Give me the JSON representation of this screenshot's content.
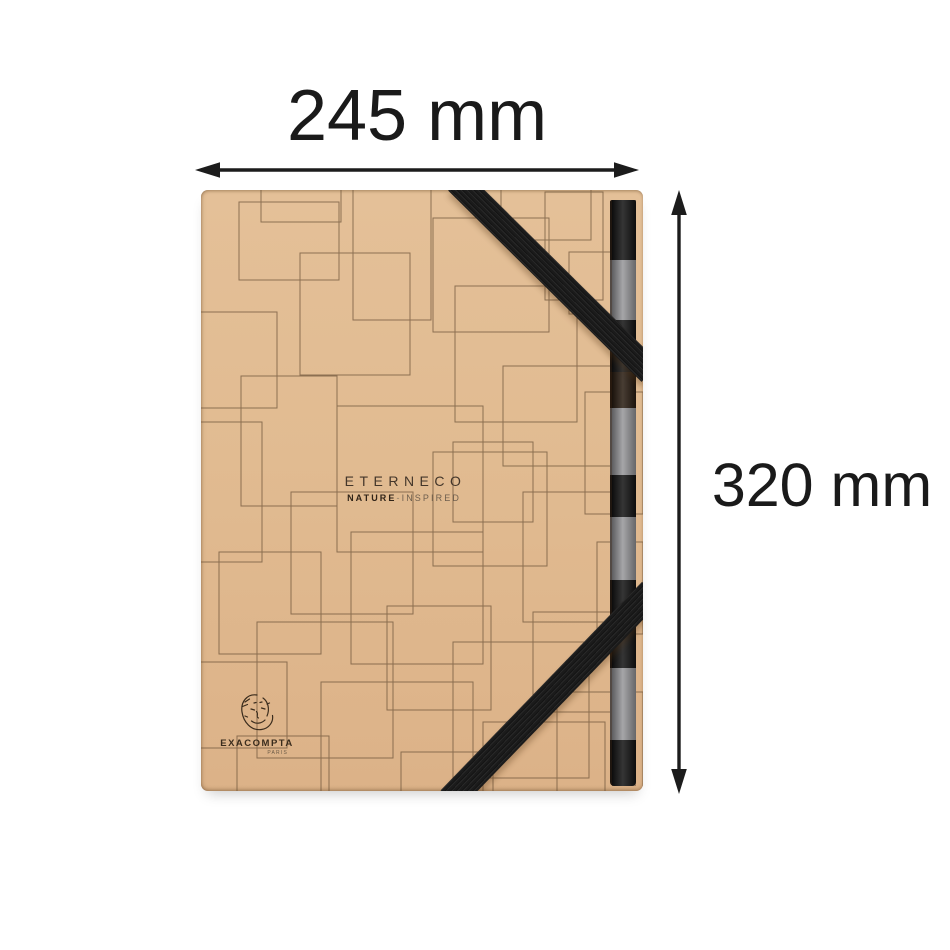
{
  "dimensions": {
    "width_label": "245 mm",
    "height_label": "320 mm"
  },
  "product": {
    "name": "ETERNECO",
    "tagline_bold": "NATURE",
    "tagline_sep": "-",
    "tagline_light": "INSPIRED",
    "maker": "EXACOMPTA",
    "maker_city": "PARIS"
  },
  "icons": {
    "logo_sketch": "exacompta-face-sketch-icon",
    "width_arrow": "double-headed-horizontal-arrow",
    "height_arrow": "double-headed-vertical-arrow"
  },
  "colors": {
    "background": "#ffffff",
    "kraft": "#e1bb91",
    "pattern_line": "#6b5238",
    "elastic_band": "#1b1b1b",
    "tab_black": "#141414",
    "tab_gray": "#97979a",
    "dimension_text": "#1a1a1a"
  }
}
